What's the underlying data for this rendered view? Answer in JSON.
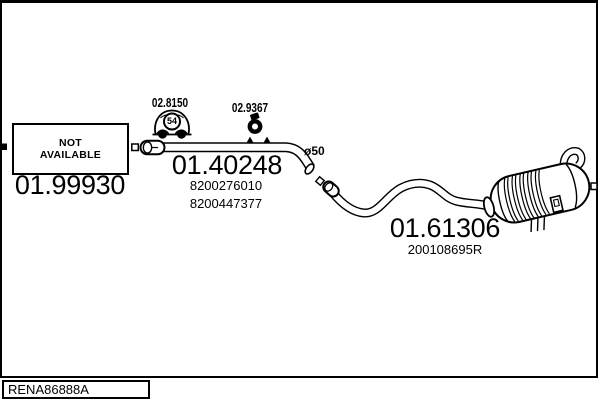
{
  "colors": {
    "ink": "#000000",
    "paper": "#ffffff"
  },
  "parts": {
    "not_available": {
      "line1": "NOT",
      "line2": "AVAILABLE",
      "code": "01.99930"
    },
    "gasket": {
      "code": "02.8150",
      "badge": "54"
    },
    "clamp": {
      "code": "02.9367"
    },
    "mid_pipe": {
      "code": "01.40248",
      "oem_numbers": [
        "8200276010",
        "8200447377"
      ],
      "diameter": "ø50"
    },
    "rear_muffler": {
      "code": "01.61306",
      "oem_number": "200108695R"
    }
  },
  "icons": {
    "vehicle_badge": "car-fitment-icon",
    "clamp": "pipe-clamp-icon"
  },
  "footer": {
    "reference": "RENA86888A"
  }
}
